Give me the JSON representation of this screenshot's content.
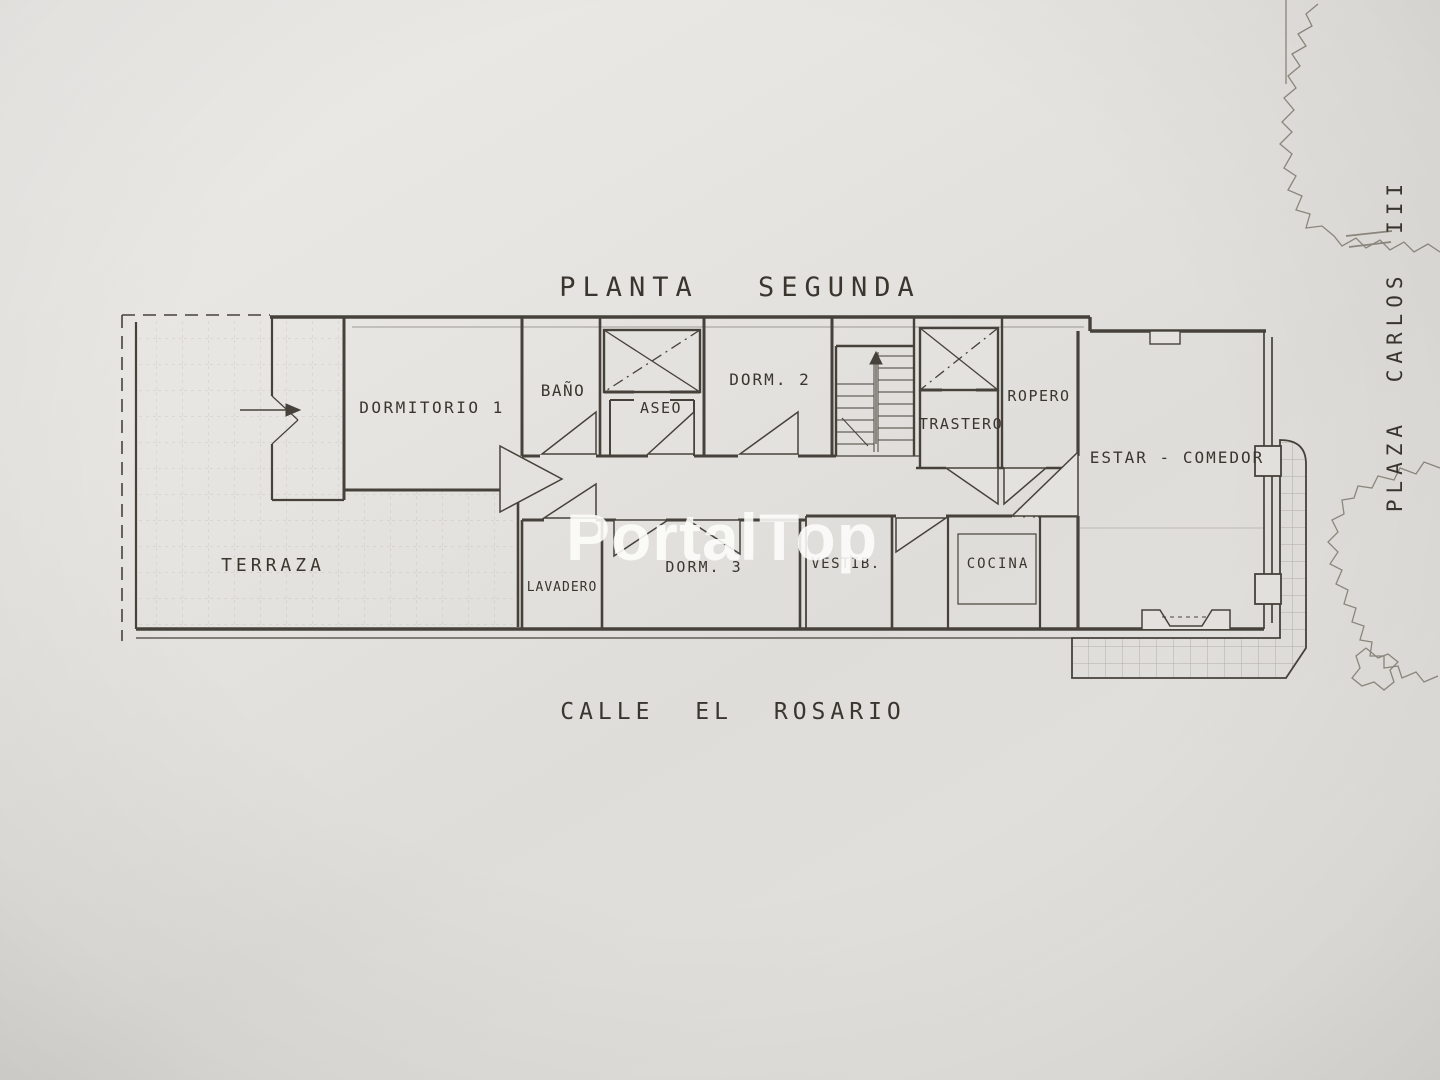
{
  "title": {
    "text": "PLANTA SEGUNDA"
  },
  "streets": {
    "bottom": "CALLE EL ROSARIO",
    "right": "PLAZA CARLOS III"
  },
  "rooms": {
    "terraza": "TERRAZA",
    "dormitorio1": "DORMITORIO 1",
    "bano": "BAÑO",
    "aseo": "ASEO",
    "dorm2": "DORM. 2",
    "trastero": "TRASTERO",
    "ropero": "ROPERO",
    "estar_comedor": "ESTAR - COMEDOR",
    "lavadero": "LAVADERO",
    "dorm3": "DORM. 3",
    "vestibulo": "VESTIB.",
    "cocina": "COCINA"
  },
  "watermark": {
    "text": "PortalTop",
    "color": "#ffffff"
  },
  "colors": {
    "paper": "#e4e2de",
    "ink": "#46423b",
    "tile_grid": "#6e695f",
    "tree_outline": "#8d897f",
    "watermark": "#fdfdfb"
  }
}
